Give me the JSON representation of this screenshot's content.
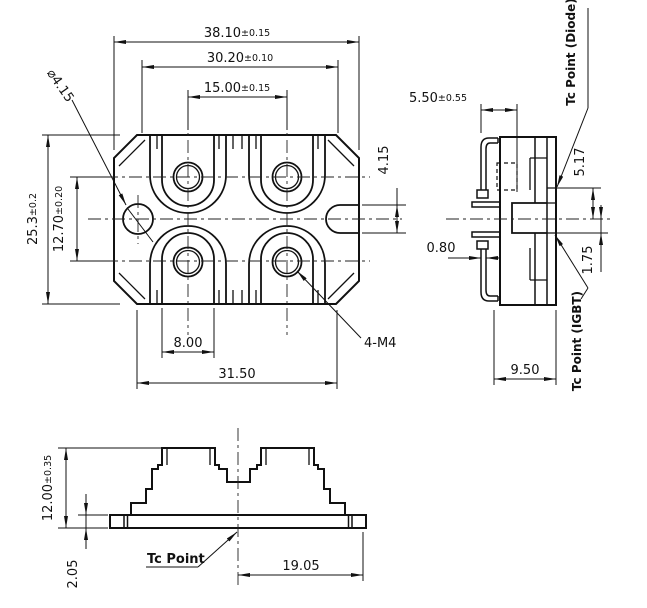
{
  "views": {
    "top": {
      "dims": {
        "overall_width": {
          "value": "38.10",
          "tol": "±0.15"
        },
        "substrate_width": {
          "value": "30.20",
          "tol": "±0.10"
        },
        "terminal_pitch": {
          "value": "15.00",
          "tol": "±0.15"
        },
        "overall_depth": {
          "value": "25.3",
          "tol": "±0.2"
        },
        "terminal_row_pitch": {
          "value": "12.70",
          "tol": "±0.20"
        },
        "mount_hole_diameter": "⌀4.15",
        "mount_slot_width": "4.15",
        "pocket_width": "8.00",
        "mount_hole_span": "31.50"
      },
      "labels": {
        "screw_thread": "4-M4"
      }
    },
    "side": {
      "dims": {
        "terminal_offset": {
          "value": "5.50",
          "tol": "±0.55"
        },
        "terminal_thickness": "0.80",
        "tc_diode_offset": "5.17",
        "tc_igbt_offset": "1.75",
        "body_depth": "9.50"
      },
      "labels": {
        "tc_diode": "Tc Point (Diode)",
        "tc_igbt": "Tc Point (IGBT)"
      }
    },
    "front": {
      "dims": {
        "overall_height": {
          "value": "12.00",
          "tol": "±0.35"
        },
        "baseplate_thickness": "2.05",
        "tc_offset": "19.05"
      },
      "labels": {
        "tc": "Tc Point"
      }
    }
  }
}
